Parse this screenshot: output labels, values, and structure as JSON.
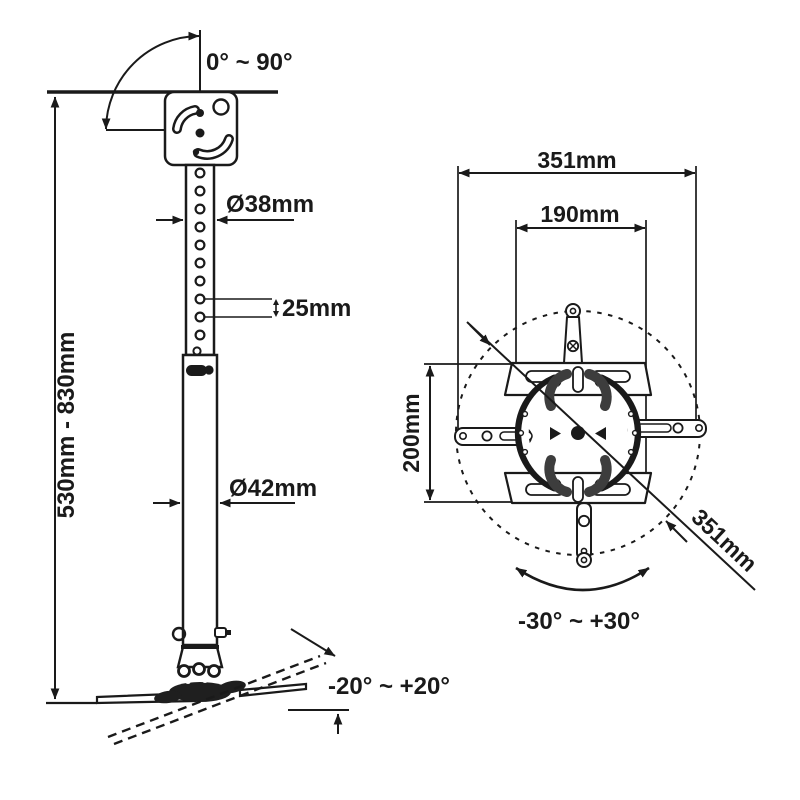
{
  "page": {
    "background": "#ffffff",
    "ink": "#1a1a1a",
    "hardware_gray": "#3d3d3d",
    "description": "Technical line drawing of a projector ceiling mount: side view with telescoping pole (left) and top view of mounting spider plate (right)"
  },
  "side_view": {
    "tilt_range_label": "0° ~ 90°",
    "upper_pole_diameter_label": "Ø38mm",
    "hole_spacing_label": "25mm",
    "height_range_label": "530mm - 830mm",
    "lower_pole_diameter_label": "Ø42mm",
    "plate_tilt_range_label": "-20° ~ +20°"
  },
  "top_view": {
    "outer_width_label": "351mm",
    "inner_width_label": "190mm",
    "plate_height_label": "200mm",
    "diagonal_label": "351mm",
    "rotation_range_label": "-30° ~ +30°"
  }
}
